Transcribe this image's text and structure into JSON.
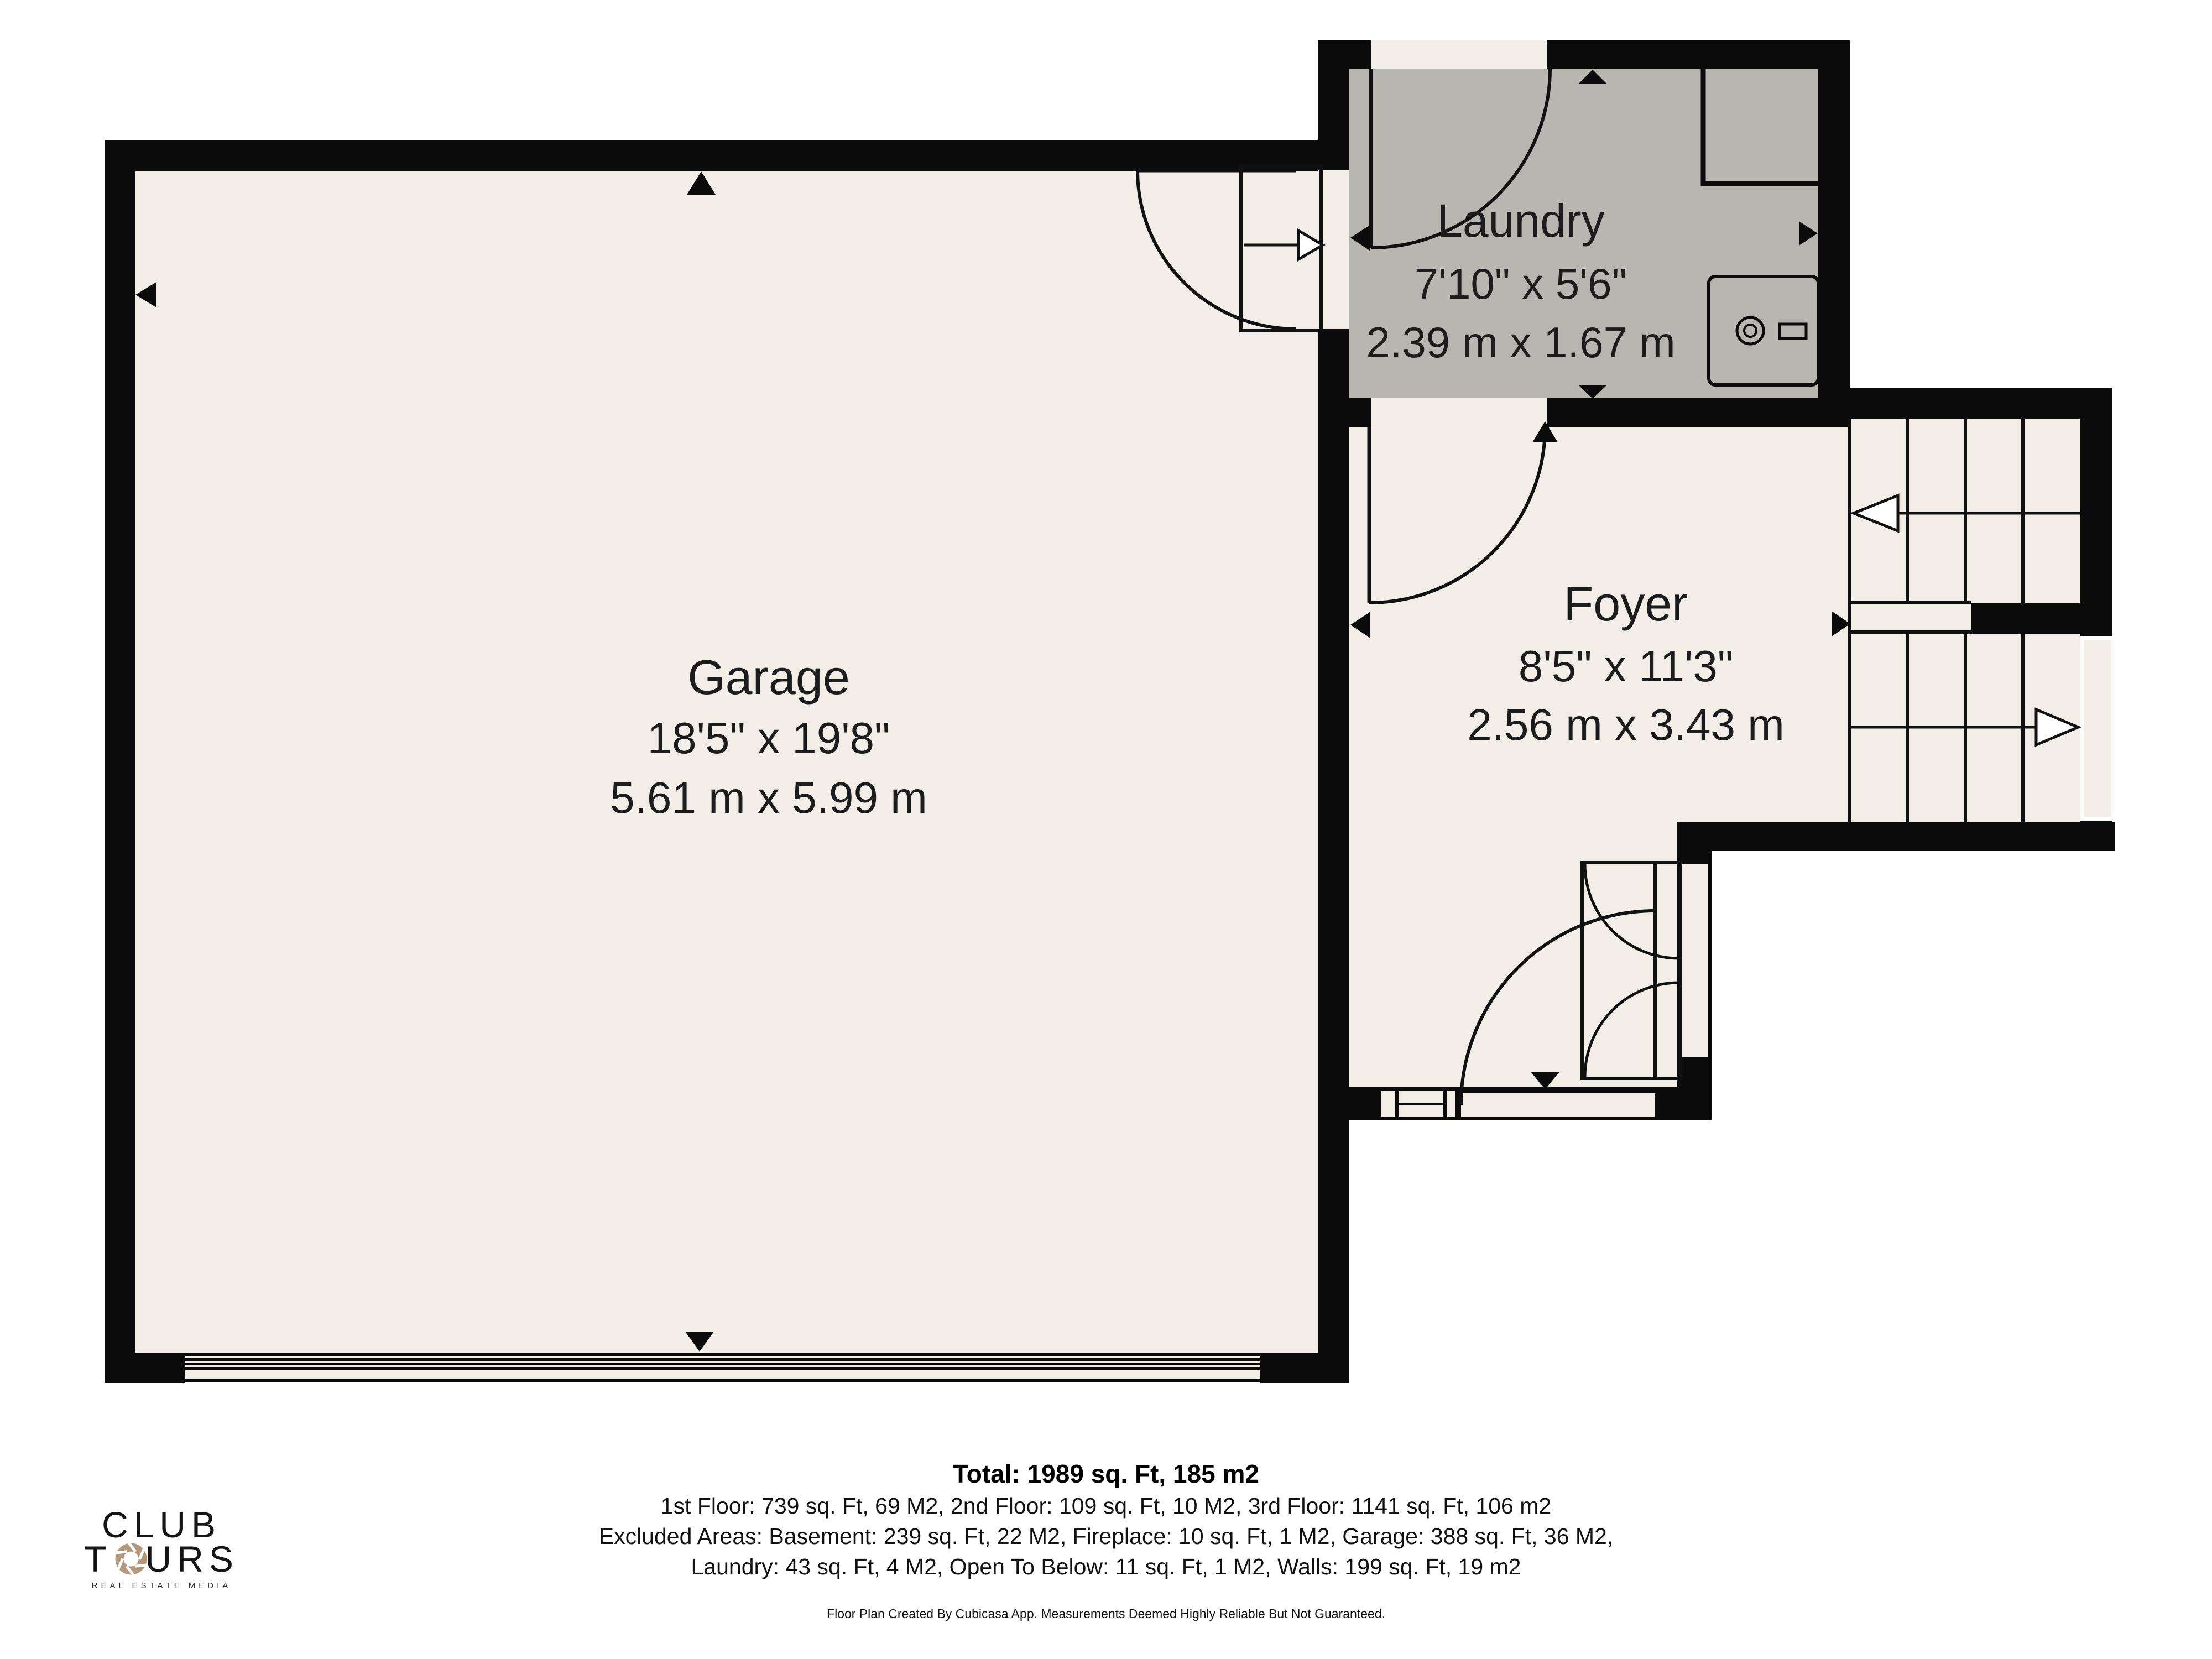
{
  "rooms": {
    "garage": {
      "name": "Garage",
      "imperial": "18'5\" x 19'8\"",
      "metric": "5.61 m x 5.99 m"
    },
    "laundry": {
      "name": "Laundry",
      "imperial": "7'10\" x 5'6\"",
      "metric": "2.39 m x 1.67 m"
    },
    "foyer": {
      "name": "Foyer",
      "imperial": "8'5\" x 11'3\"",
      "metric": "2.56 m x 3.43 m"
    }
  },
  "summary": {
    "total": "Total: 1989 sq. Ft, 185 m2",
    "floors": "1st Floor: 739 sq. Ft, 69 M2, 2nd Floor: 109 sq. Ft, 10 M2, 3rd Floor: 1141 sq. Ft, 106 m2",
    "excluded_1": "Excluded Areas: Basement: 239 sq. Ft, 22 M2, Fireplace: 10 sq. Ft, 1 M2, Garage: 388 sq. Ft, 36 M2,",
    "excluded_2": "Laundry: 43 sq. Ft, 4 M2, Open To Below: 11 sq. Ft, 1 M2, Walls: 199 sq. Ft, 19 m2",
    "disclaimer": "Floor Plan Created By Cubicasa App. Measurements Deemed Highly Reliable But Not Guaranteed."
  },
  "logo": {
    "line1": "CLUB",
    "line2_pre": "T",
    "line2_o": "O",
    "line2_post": "URS",
    "tagline": "REAL ESTATE MEDIA"
  },
  "colors": {
    "wall": "#0b0b0b",
    "floor": "#f2eee7",
    "laundry_floor": "#b8b6b1",
    "accent_tan": "#b3987a"
  }
}
